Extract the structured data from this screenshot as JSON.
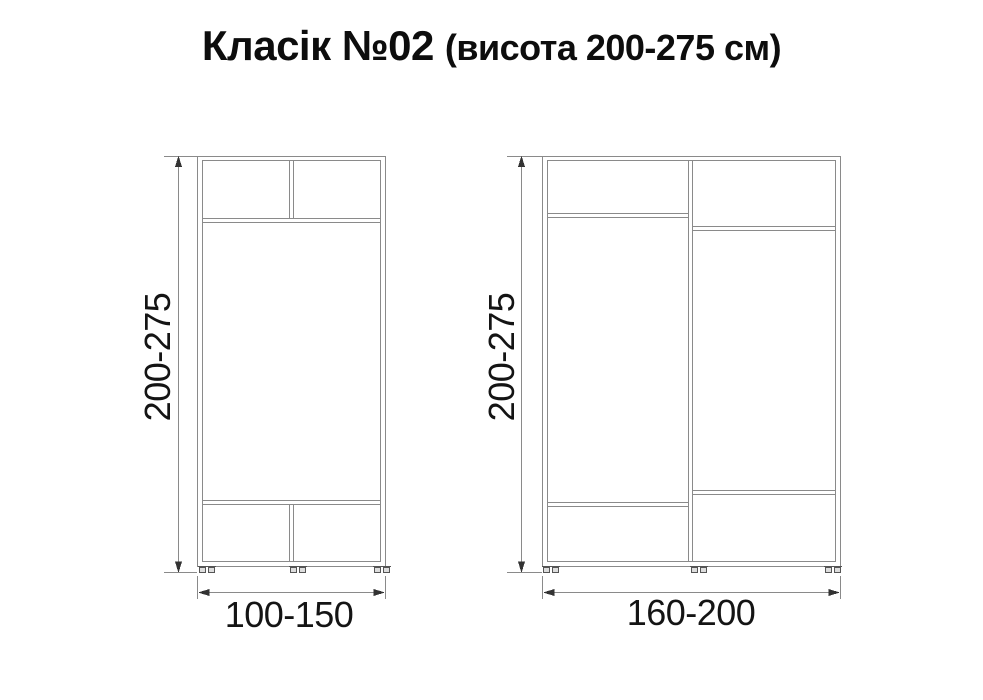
{
  "title": {
    "main": "Класік №02",
    "suffix": "(висота 200-275 см)"
  },
  "cabinets": [
    {
      "name": "narrow-wardrobe",
      "height_label": "200-275",
      "width_label": "100-150"
    },
    {
      "name": "wide-wardrobe",
      "height_label": "200-275",
      "width_label": "160-200"
    }
  ],
  "colors": {
    "background": "#ffffff",
    "drawing_line": "#8a8a8a",
    "foot_line": "#555555",
    "dimension_arrow": "#333333",
    "text": "#141414"
  }
}
